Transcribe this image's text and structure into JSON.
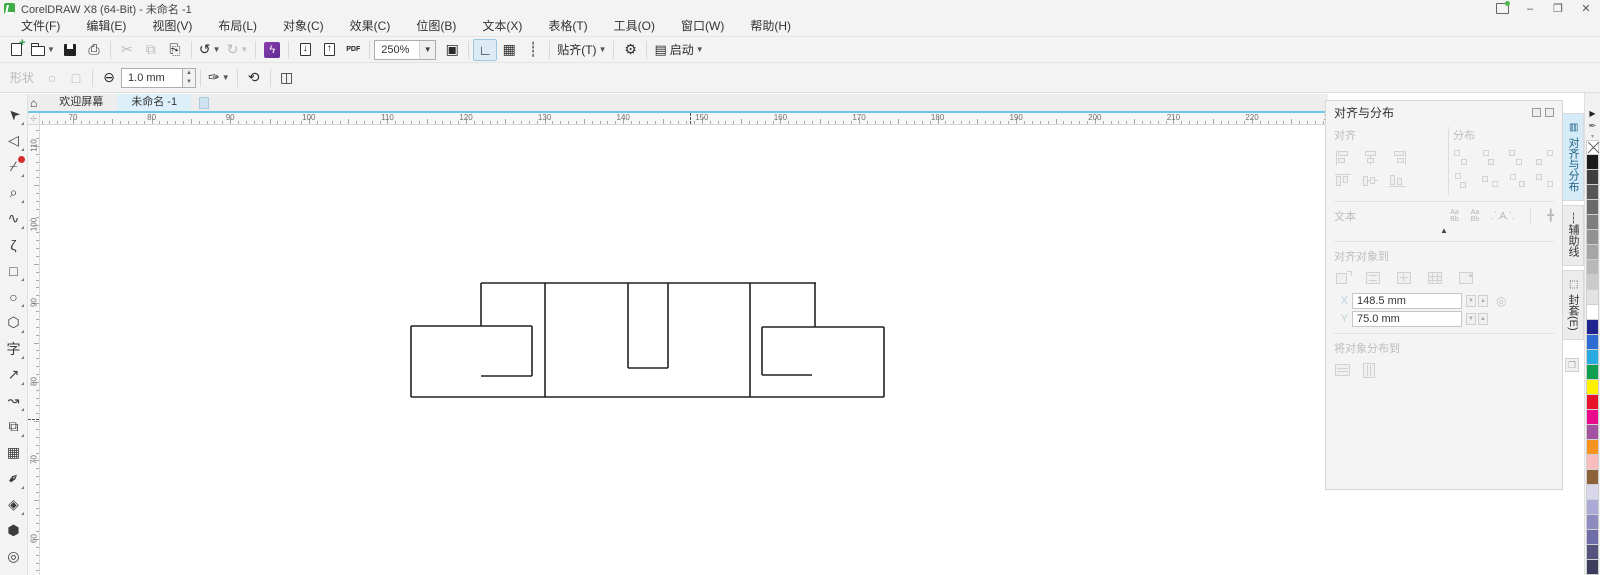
{
  "window": {
    "title": "CorelDRAW X8 (64-Bit) - 未命名 -1"
  },
  "menu": {
    "items": [
      "文件(F)",
      "编辑(E)",
      "视图(V)",
      "布局(L)",
      "对象(C)",
      "效果(C)",
      "位图(B)",
      "文本(X)",
      "表格(T)",
      "工具(O)",
      "窗口(W)",
      "帮助(H)"
    ]
  },
  "standard_toolbar": {
    "zoom_level": "250%",
    "snap_label": "贴齐(T)",
    "launch_label": "启动",
    "pdf_label": "PDF"
  },
  "property_bar": {
    "shape_label": "形状",
    "outline_width": "1.0 mm"
  },
  "tab_bar": {
    "welcome_label": "欢迎屏幕",
    "document_label": "未命名 -1"
  },
  "toolbox": {
    "tools": [
      {
        "name": "pick-tool",
        "glyph": "➤",
        "rot": -135,
        "flyout": true
      },
      {
        "name": "shape-tool",
        "glyph": "◁",
        "rot": 0,
        "flyout": true
      },
      {
        "name": "crop-tool",
        "glyph": "⌿",
        "rot": 0,
        "flyout": true,
        "badge": true
      },
      {
        "name": "zoom-tool",
        "glyph": "⌕",
        "rot": 0,
        "flyout": true
      },
      {
        "name": "freehand-tool",
        "glyph": "∿",
        "rot": 0,
        "flyout": true
      },
      {
        "name": "artistic-media-tool",
        "glyph": "ζ",
        "rot": 0,
        "flyout": false
      },
      {
        "name": "rectangle-tool",
        "glyph": "□",
        "rot": 0,
        "flyout": true
      },
      {
        "name": "ellipse-tool",
        "glyph": "○",
        "rot": 0,
        "flyout": true
      },
      {
        "name": "polygon-tool",
        "glyph": "⬡",
        "rot": 0,
        "flyout": true
      },
      {
        "name": "text-tool",
        "glyph": "字",
        "rot": 0,
        "flyout": true
      },
      {
        "name": "dimension-tool",
        "glyph": "↗",
        "rot": 0,
        "flyout": true
      },
      {
        "name": "connector-tool",
        "glyph": "↝",
        "rot": 0,
        "flyout": true
      },
      {
        "name": "drop-shadow-tool",
        "glyph": "⧉",
        "rot": 0,
        "flyout": true
      },
      {
        "name": "transparency-tool",
        "glyph": "▦",
        "rot": 0,
        "flyout": false
      },
      {
        "name": "eyedropper-tool",
        "glyph": "✒",
        "rot": -45,
        "flyout": true
      },
      {
        "name": "interactive-fill-tool",
        "glyph": "◈",
        "rot": 0,
        "flyout": true
      },
      {
        "name": "smart-fill-tool",
        "glyph": "⬢",
        "rot": 0,
        "flyout": false
      },
      {
        "name": "outline-tool",
        "glyph": "◎",
        "rot": 0,
        "flyout": false
      }
    ]
  },
  "rulers": {
    "unit_mm_per_major": 10,
    "h_ticks": [
      70,
      80,
      90,
      100,
      110,
      120,
      130,
      140,
      150,
      160,
      170,
      180,
      190,
      200,
      210,
      220,
      230
    ],
    "h_origin_px": 73,
    "h_spacing_px": 78.6,
    "h_center_marker_px": 690,
    "v_ticks": [
      110,
      100,
      90,
      80,
      70,
      60
    ],
    "v_origin_px": 146,
    "v_spacing_px": 78.6,
    "v_center_marker_px": 419
  },
  "docker": {
    "title": "对齐与分布",
    "align_label": "对齐",
    "distribute_label": "分布",
    "text_label": "文本",
    "align_to_label": "对齐对象到",
    "x_value": "148.5 mm",
    "y_value": "75.0 mm",
    "distribute_to_label": "将对象分布到",
    "text_icons": [
      "Aa|Bb",
      "Aa|Bb",
      "A",
      "+"
    ]
  },
  "side_tabs": [
    {
      "label": "对齐与分布",
      "icon": "▤",
      "active": true
    },
    {
      "label": "辅助线",
      "icon": "┆",
      "active": false
    },
    {
      "label": "封套(E)",
      "icon": "⬚",
      "active": false
    }
  ],
  "palette": {
    "colors": [
      "#1b1b1b",
      "#3f3f3f",
      "#565656",
      "#6a6a6a",
      "#7e7e7e",
      "#929292",
      "#a5a5a5",
      "#b8b8b8",
      "#cbcbcb",
      "#e3e3e3",
      "#ffffff",
      "#20248f",
      "#2d6bd3",
      "#29abe2",
      "#0f9f4f",
      "#fff100",
      "#e8132a",
      "#ea0a8c",
      "#a1539f",
      "#f7941e",
      "#f7bcbc",
      "#8c6239",
      "#d9d7ec",
      "#aba9d6",
      "#8d8bc0",
      "#6f6da8",
      "#55537e",
      "#3e3c5c"
    ]
  },
  "canvas_drawing": {
    "stroke": "#222222",
    "stroke_width": 1.6,
    "segments": [
      [
        481,
        283,
        816,
        283
      ],
      [
        481,
        283,
        481,
        326
      ],
      [
        411,
        326,
        532,
        326
      ],
      [
        411,
        326,
        411,
        397
      ],
      [
        411,
        397,
        884,
        397
      ],
      [
        532,
        326,
        532,
        376
      ],
      [
        481,
        376,
        532,
        376
      ],
      [
        545,
        283,
        545,
        397
      ],
      [
        750,
        283,
        750,
        397
      ],
      [
        628,
        283,
        628,
        368
      ],
      [
        668,
        283,
        668,
        368
      ],
      [
        628,
        368,
        668,
        368
      ],
      [
        815,
        283,
        815,
        327
      ],
      [
        762,
        327,
        884,
        327
      ],
      [
        884,
        327,
        884,
        397
      ],
      [
        762,
        327,
        762,
        375
      ],
      [
        762,
        375,
        812,
        375
      ]
    ]
  }
}
